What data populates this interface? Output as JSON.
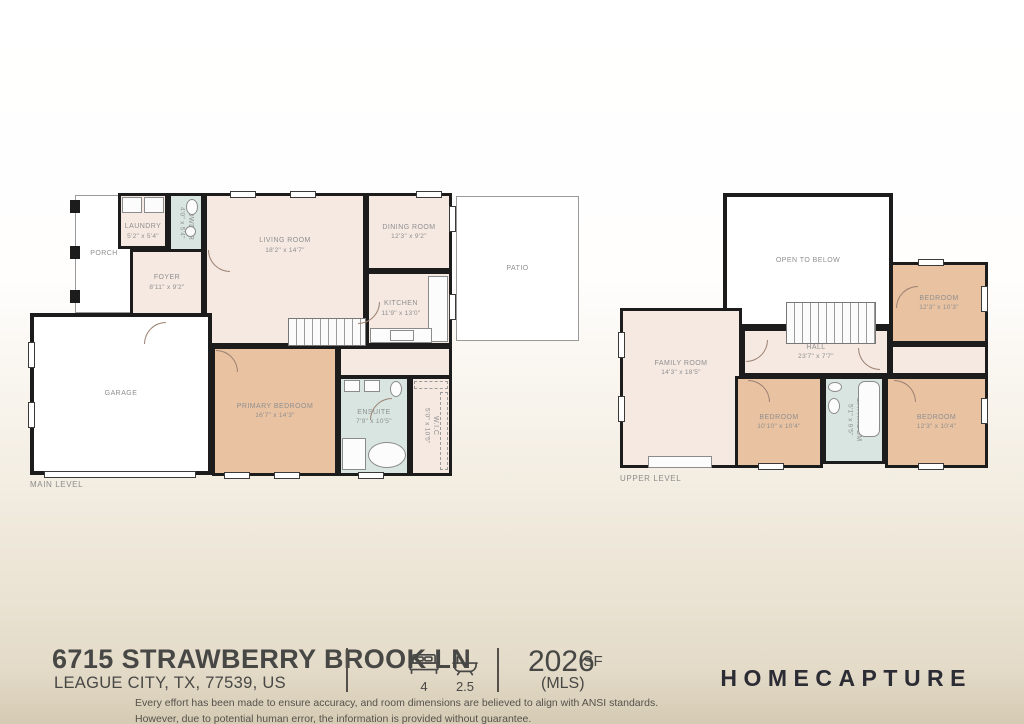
{
  "colors": {
    "wall": "#1c1c1c",
    "room_pink": "#f5e9e2",
    "room_tan": "#e9c2a2",
    "room_blue": "#d8e5e1",
    "label_gray": "#8f8f8f",
    "footer_text": "#474745",
    "brand_dark": "#2c2c34"
  },
  "plans": {
    "main": {
      "caption": "MAIN LEVEL",
      "rooms": {
        "porch": {
          "name": "PORCH",
          "dims": ""
        },
        "laundry": {
          "name": "LAUNDRY",
          "dims": "5'2\" x 5'4\""
        },
        "powder": {
          "name": "POWDER",
          "dims": "4'0\" x 5'4\""
        },
        "foyer": {
          "name": "FOYER",
          "dims": "8'11\" x 9'2\""
        },
        "living": {
          "name": "LIVING ROOM",
          "dims": "18'2\" x 14'7\""
        },
        "dining": {
          "name": "DINING ROOM",
          "dims": "12'3\" x 9'2\""
        },
        "kitchen": {
          "name": "KITCHEN",
          "dims": "11'9\" x 13'0\""
        },
        "patio": {
          "name": "PATIO",
          "dims": ""
        },
        "garage": {
          "name": "GARAGE",
          "dims": ""
        },
        "primary": {
          "name": "PRIMARY BEDROOM",
          "dims": "16'7\" x 14'3\""
        },
        "ensuite": {
          "name": "ENSUITE",
          "dims": "7'9\" x 10'5\""
        },
        "wic": {
          "name": "W.I.C",
          "dims": "5'0\" x 10'5\""
        }
      }
    },
    "upper": {
      "caption": "UPPER LEVEL",
      "rooms": {
        "open": {
          "name": "OPEN TO BELOW",
          "dims": ""
        },
        "family": {
          "name": "FAMILY ROOM",
          "dims": "14'3\" x 18'5\""
        },
        "hall": {
          "name": "HALL",
          "dims": "23'7\" x 7'7\""
        },
        "bedroom_tr": {
          "name": "BEDROOM",
          "dims": "12'3\" x 10'3\""
        },
        "bedroom_bm": {
          "name": "BEDROOM",
          "dims": "10'10\" x 10'4\""
        },
        "bathroom": {
          "name": "BATHROOM",
          "dims": "5'1\" x 9'5\""
        },
        "bedroom_br": {
          "name": "BEDROOM",
          "dims": "12'3\" x 10'4\""
        }
      }
    }
  },
  "footer": {
    "address_line1": "6715 STRAWBERRY BROOK LN",
    "address_line2": "LEAGUE CITY, TX, 77539, US",
    "beds": "4",
    "baths": "2.5",
    "sf_value": "2026",
    "sf_unit": "SF",
    "sf_source": "(MLS)",
    "brand": "HOMECAPTURE",
    "disclaimer_line1": "Every effort has been made to ensure accuracy, and room dimensions are believed to align with ANSI standards.",
    "disclaimer_line2": "However, due to potential human error, the information is provided without guarantee."
  }
}
